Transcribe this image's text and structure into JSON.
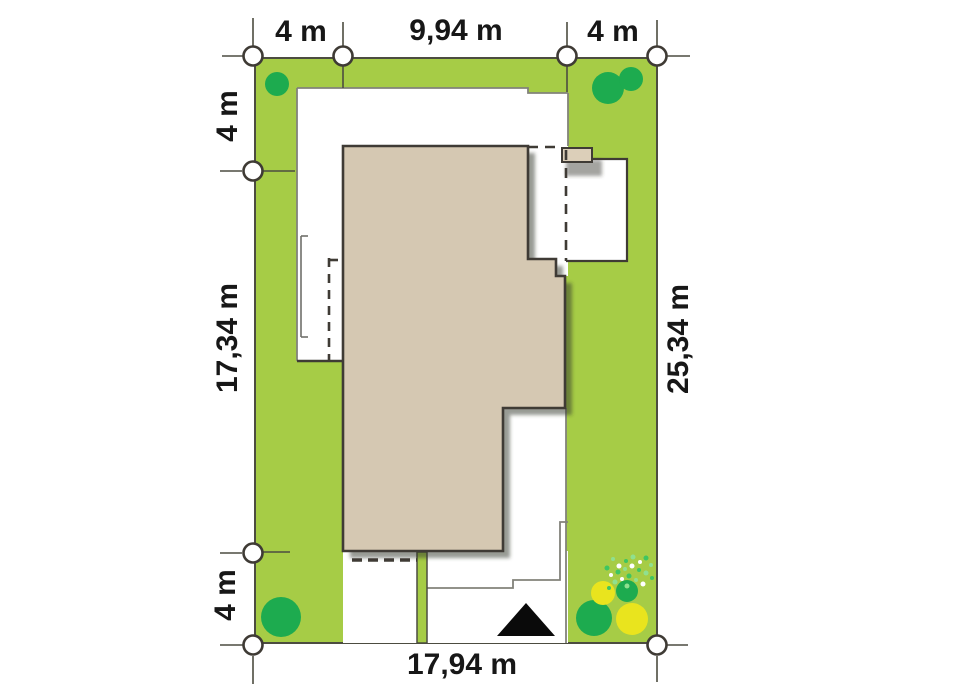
{
  "diagram": {
    "type": "residential-site-plan-top-view",
    "dimensions": {
      "top_left_setback": "4 m",
      "top_house_width": "9,94 m",
      "top_right_setback": "4 m",
      "left_top_setback": "4 m",
      "left_house_depth": "17,34 m",
      "left_bottom_setback": "4 m",
      "right_plot_depth": "25,34 m",
      "bottom_plot_width": "17,94 m"
    },
    "colors": {
      "lawn_green": "#a6cc46",
      "tree_green": "#1dab4f",
      "shrub_yellow": "#e9e41e",
      "house_beige": "#d5c8b2",
      "chimney_beige": "#dccfb9",
      "outline_dark": "#3f3b35",
      "path_gray": "#82827a",
      "marker_white": "#ffffff",
      "north_arrow_black": "#0a0a0a"
    }
  }
}
